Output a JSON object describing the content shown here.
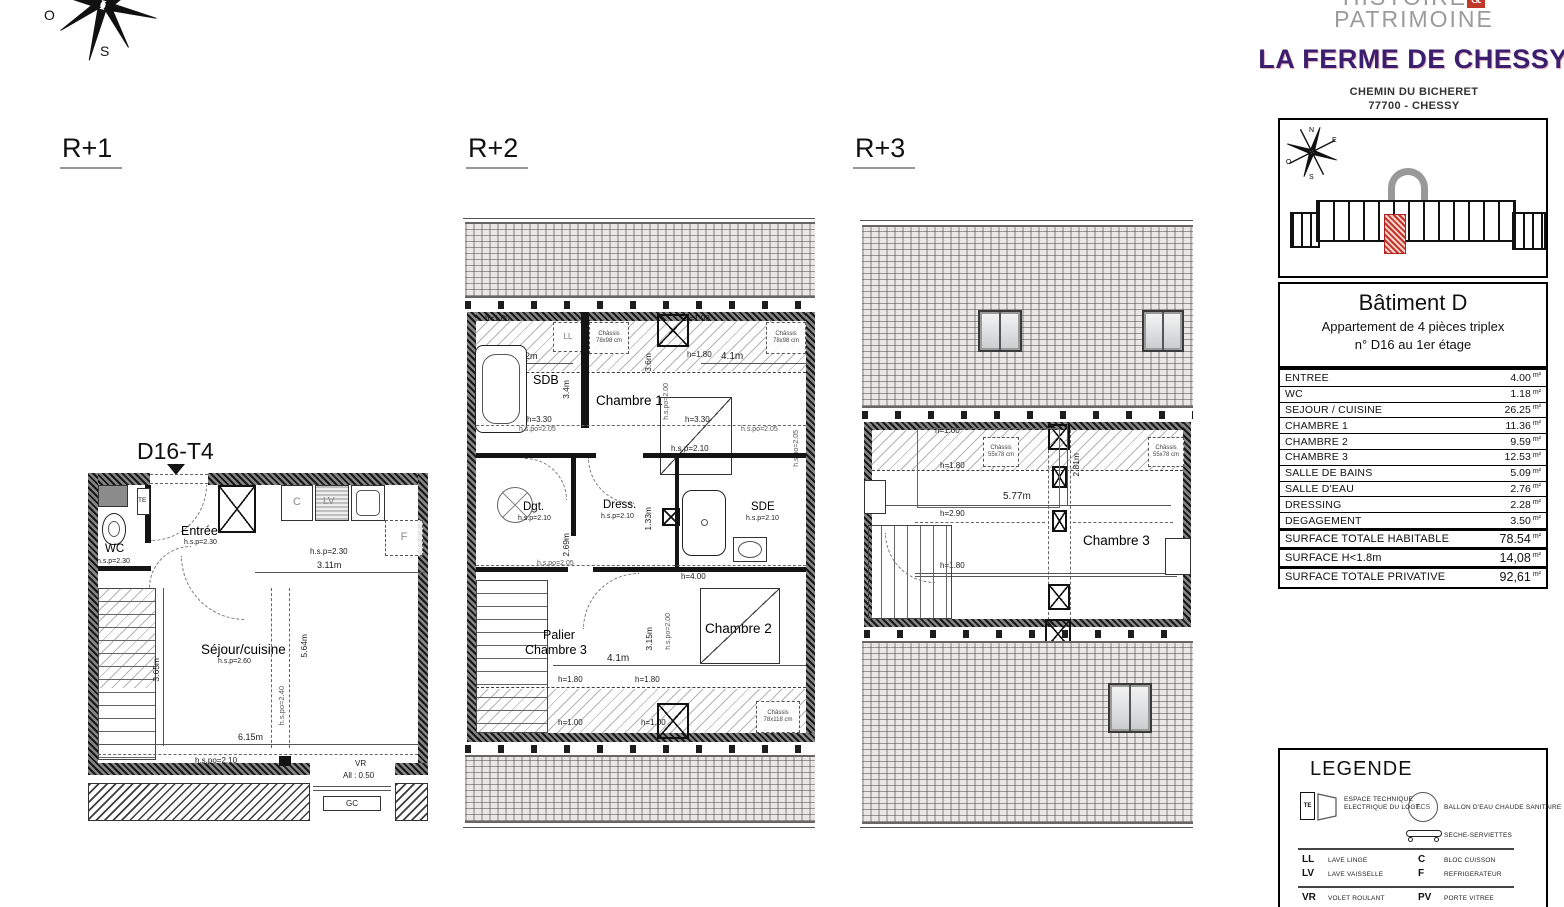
{
  "header": {
    "logo_line1": "HISTOIRE",
    "logo_amp": "&",
    "logo_line2": "PATRIMOINE",
    "title": "LA FERME DE CHESSY",
    "address1": "CHEMIN DU BICHERET",
    "address2": "77700 - CHESSY"
  },
  "compass": {
    "n": "N",
    "e": "E",
    "s": "S",
    "o": "O"
  },
  "floors": {
    "f1": "R+1",
    "f2": "R+2",
    "f3": "R+3"
  },
  "unit_tag": "D16-T4",
  "r1": {
    "te": "TE",
    "wc": "WC",
    "wc_h": "h.s.p=2.30",
    "entree": "Entrée",
    "entree_h": "h.s.p=2.30",
    "c": "C",
    "lv": "LV",
    "f": "F",
    "kitchen_h": "h.s.p=2.30",
    "d311": "3.11m",
    "sejour": "Séjour/cuisine",
    "sejour_h": "h.s.p=2.60",
    "d365": "3.65m",
    "d564": "5.64m",
    "hspo240": "h.s.po=2.40",
    "d615": "6.15m",
    "hspo210": "h.s.po=2.10",
    "vr": "VR",
    "all050": "All : 0.50",
    "gc": "GC"
  },
  "r2": {
    "h100_tl": "h=1.00",
    "h100_tr": "h=1.00",
    "ll": "LL",
    "chassis_tl": "Châssis 78x98 cm",
    "chassis_tr": "Châssis 78x98 cm",
    "h180_tl": "h=1.80",
    "h180_tr": "h=1.80",
    "d2m": "2m",
    "d41t": "4.1m",
    "sdb": "SDB",
    "d34": "3.4m",
    "d36": "3.6m",
    "chambre1": "Chambre 1",
    "h330_l": "h=3.30",
    "h330_r": "h=3.30",
    "hspo205_l": "h.s.po=2.05",
    "hspo205_r": "h.s.po=2.05",
    "hspo205_ml": "h.s.po=2.05",
    "hspo205_mr": "h.s.po=2.05",
    "hspo200_t": "h.s.po=2.00",
    "hsp210_ch1": "h.s.p=2.10",
    "ecs": "ECS",
    "dgt": "Dgt.",
    "dgt_h": "h.s.p=2.10",
    "dress": "Dress.",
    "dress_h": "h.s.p=2.10",
    "d133": "1.33m",
    "sde": "SDE",
    "sde_h": "h.s.p=2.10",
    "d269": "2.69m",
    "h400": "h=4.00",
    "palier": "Palier",
    "palier_ch3": "Chambre 3",
    "chambre2": "Chambre 2",
    "d41b": "4.1m",
    "d315": "3.15m",
    "hspo200_b": "h.s.po=2.00",
    "h180_bl": "h=1.80",
    "h180_br": "h=1.80",
    "h100_bl": "h=1.00",
    "h100_br": "h=1.00",
    "chassis_b": "Châssis 78x118 cm"
  },
  "r3": {
    "h100": "h=1.00",
    "chassis_l": "Châssis 55x78 cm",
    "chassis_r": "Châssis 55x78 cm",
    "h180_t": "h=1.80",
    "d577": "5.77m",
    "d281": "2.81m",
    "h290": "h=2.90",
    "chambre3": "Chambre 3",
    "h180_b": "h=1.80"
  },
  "panel": {
    "building_title": "Bâtiment D",
    "building_line2": "Appartement de 4 pièces triplex",
    "building_line3": "n° D16 au 1er étage",
    "unit": "m²",
    "rows": [
      {
        "label": "ENTREE",
        "value": "4.00"
      },
      {
        "label": "WC",
        "value": "1.18"
      },
      {
        "label": "SEJOUR / CUISINE",
        "value": "26.25"
      },
      {
        "label": "CHAMBRE 1",
        "value": "11.36"
      },
      {
        "label": "CHAMBRE 2",
        "value": "9.59"
      },
      {
        "label": "CHAMBRE 3",
        "value": "12.53"
      },
      {
        "label": "SALLE DE BAINS",
        "value": "5.09"
      },
      {
        "label": "SALLE D'EAU",
        "value": "2.76"
      },
      {
        "label": "DRESSING",
        "value": "2.28"
      },
      {
        "label": "DEGAGEMENT",
        "value": "3.50"
      }
    ],
    "totals": [
      {
        "label": "SURFACE TOTALE HABITABLE",
        "value": "78.54"
      },
      {
        "label": "SURFACE H<1.8m",
        "value": "14,08"
      },
      {
        "label": "SURFACE TOTALE PRIVATIVE",
        "value": "92,61"
      }
    ],
    "legend": {
      "title": "LEGENDE",
      "te_abbr": "TE",
      "te_l1": "ESPACE TECHNIQUE",
      "te_l2": "ELECTRIQUE DU LOGT.",
      "ecs_abbr": "ECS",
      "ecs_desc": "BALLON D'EAU CHAUDE SANITAIRE",
      "seche": "SECHE-SERVIETTES",
      "ll": "LL",
      "ll_d": "LAVE LINGE",
      "c": "C",
      "c_d": "BLOC CUISSON",
      "lv": "LV",
      "lv_d": "LAVE VAISSELLE",
      "f": "F",
      "f_d": "REFRIGERATEUR",
      "vr": "VR",
      "vr_d": "VOLET ROULANT",
      "pv": "PV",
      "pv_d": "PORTE VITREE",
      "gc": "GC",
      "gc_d": "GARDE-CORPS",
      "pf": "PF",
      "pf_d": "PORTE FENETRE",
      "hsp": "h.s.p=",
      "hsp_d": "HAUTEUR SOUS PLAFOND",
      "all": "All :",
      "all_d": "HAUTEUR D'ALLEGE",
      "hspo": "h.s.po=",
      "hspo_d": "HAUTEUR SOUS POUTRE"
    }
  },
  "colors": {
    "brand_purple": "#3b1f6e",
    "logo_red": "#c0392b",
    "unit_red": "#c43428"
  }
}
